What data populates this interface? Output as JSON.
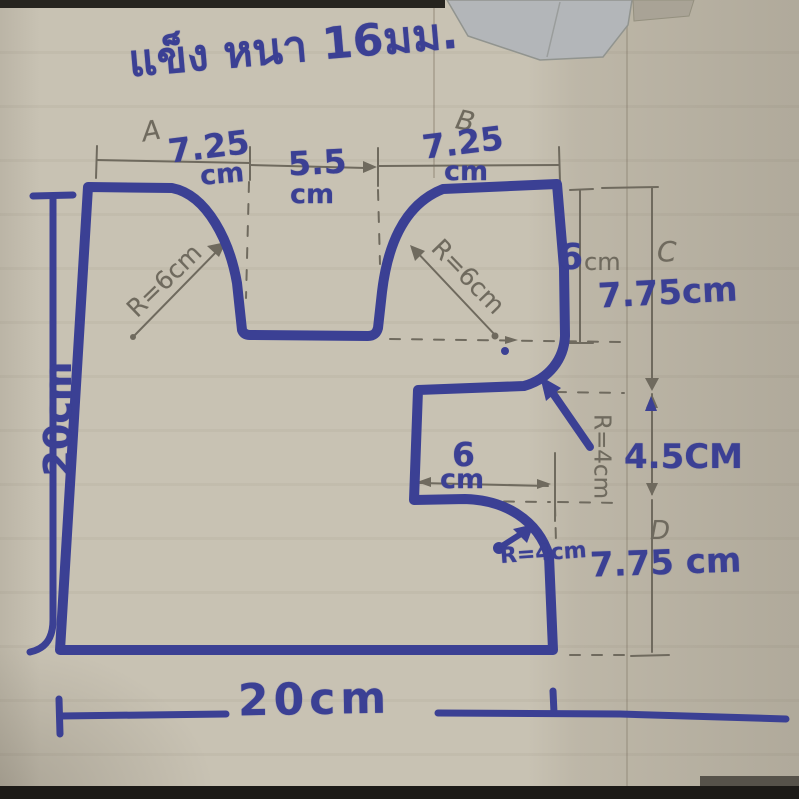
{
  "title": {
    "thai_note": "แข็ง หนา 16มม."
  },
  "points": {
    "a": "A",
    "b": "B",
    "c": "C",
    "d": "D"
  },
  "dims": {
    "top_left_value": "7.25",
    "top_left_unit": "cm",
    "top_middle_value": "5.5",
    "top_middle_unit": "cm",
    "top_right_value": "7.25",
    "top_right_unit": "cm",
    "left_total": "20cm",
    "bottom_total": "20cm",
    "notch_depth_value": "6",
    "notch_depth_unit": "cm",
    "right_upper": "7.75cm",
    "right_middle": "4.5CM",
    "right_lower": "7.75 cm",
    "step_width_value": "6",
    "step_width_unit": "cm"
  },
  "radii": {
    "top_left_curve": "R=6cm",
    "top_right_curve": "R=6cm",
    "middle_right_curve": "R=4cm",
    "bottom_step_curve": "R=4cm"
  },
  "colors": {
    "marker_blue": "#3b4094",
    "pencil_gray": "#6f6a5e",
    "cardboard": "#c8c2b3"
  }
}
